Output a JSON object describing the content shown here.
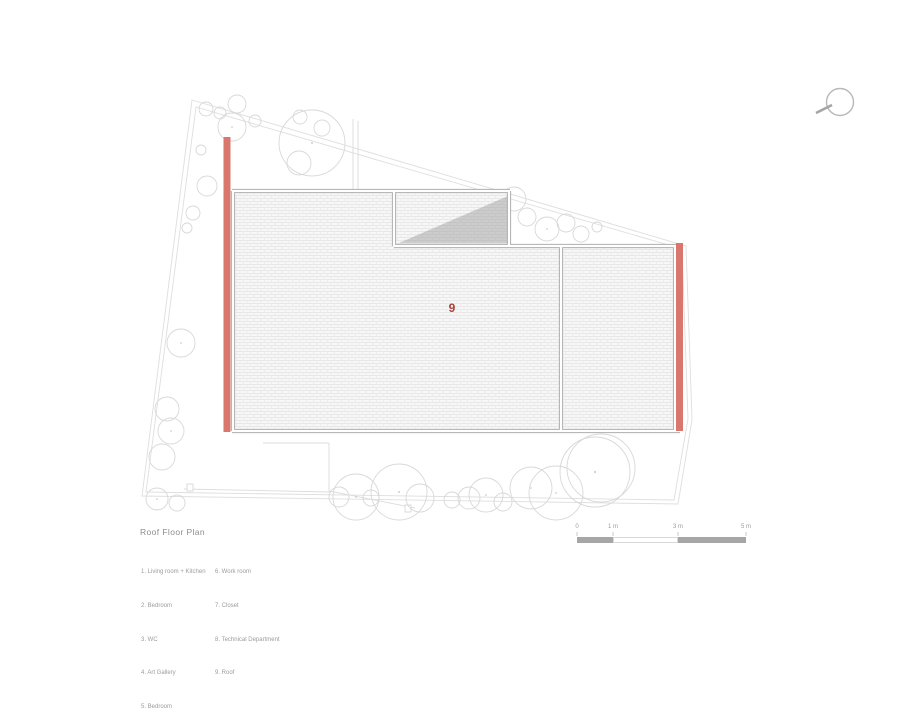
{
  "title": "Roof Floor Plan",
  "plan": {
    "roof_label": "9"
  },
  "legend": {
    "col1": [
      "1. Living room + Kitchen",
      "2. Bedroom",
      "3. WC",
      "4. Art Gallery",
      "5. Bedroom"
    ],
    "col2": [
      "6. Work room",
      "7. Closet",
      "8. Technical Department",
      "9. Roof"
    ]
  },
  "scalebar": {
    "labels": [
      "0",
      "1 m",
      "3 m",
      "5 m"
    ]
  },
  "icons": {
    "north_indicator": "compass-circle-icon",
    "trees": "tree-canopy-circles"
  },
  "colors": {
    "accent_wall": "#d9776e",
    "roof_label": "#a8423a",
    "wall_line": "#aeaeae",
    "site_line": "#dedede",
    "tree_line": "#d8d8d8",
    "hatch_bg": "#f7f7f7",
    "hatch_line": "#e3e3e3",
    "shadow": "#9e9e9e",
    "scalebar_fill": "#a6a6a6",
    "text_gray": "#9c9c9c",
    "text_title": "#8d8d8d"
  }
}
